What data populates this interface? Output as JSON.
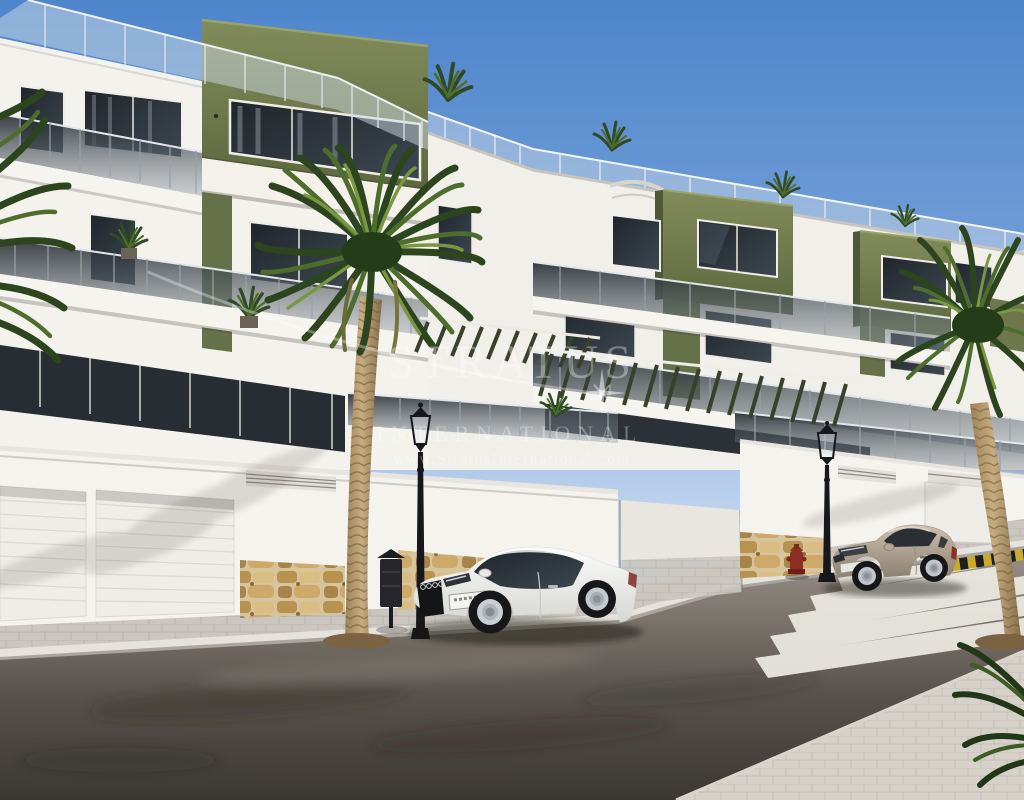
{
  "meta": {
    "type": "architectural-render",
    "description": "Street view render of a new-build apartment complex with olive-green accents, palm trees, parked cars and agency watermark"
  },
  "watermark": {
    "brand": "STRATUS",
    "subtitle": "INTERNATIONAL",
    "url": "www.StratusInternational.com"
  },
  "scene": {
    "objects": [
      "apartment-buildings",
      "roof-terrace-glass-railings",
      "olive-accent-boxes",
      "balcony-glass-balustrades",
      "tinted-windows",
      "garage-doors",
      "vent-grilles",
      "stone-wainscot-wall",
      "driveway-ramp",
      "center-palm-tree",
      "right-palm-tree",
      "left-edge-palm-fronds",
      "rooftop-shrubs",
      "balcony-plants",
      "street-lamp-left",
      "street-lamp-right",
      "litter-bin",
      "fire-hydrant",
      "white-coupe-car",
      "beige-coupe-car",
      "zebra-crosswalk",
      "hazard-striped-curb",
      "asphalt-road",
      "paved-sidewalk",
      "near-sidewalk-wedge",
      "watermark"
    ],
    "colors": {
      "sky_top": "#4e85cb",
      "sky_horizon": "#cfdcef",
      "facade_white": "#f4f2ed",
      "accent_olive": "#6d774b",
      "window_glass": "#232930",
      "balustrade_glass": "#3a434c",
      "stone": "#c9a86e",
      "sidewalk": "#cbc7c0",
      "asphalt": "#3b3733",
      "crosswalk_stripe": "#edebe3",
      "palm_green": "#4e6d2d",
      "palm_trunk": "#b3976a",
      "car_white": "#f4f4f2",
      "car_beige": "#b4a492",
      "lamp_black": "#17181c",
      "hydrant_red": "#8e2e22",
      "hazard_yellow": "#caa92b"
    }
  }
}
